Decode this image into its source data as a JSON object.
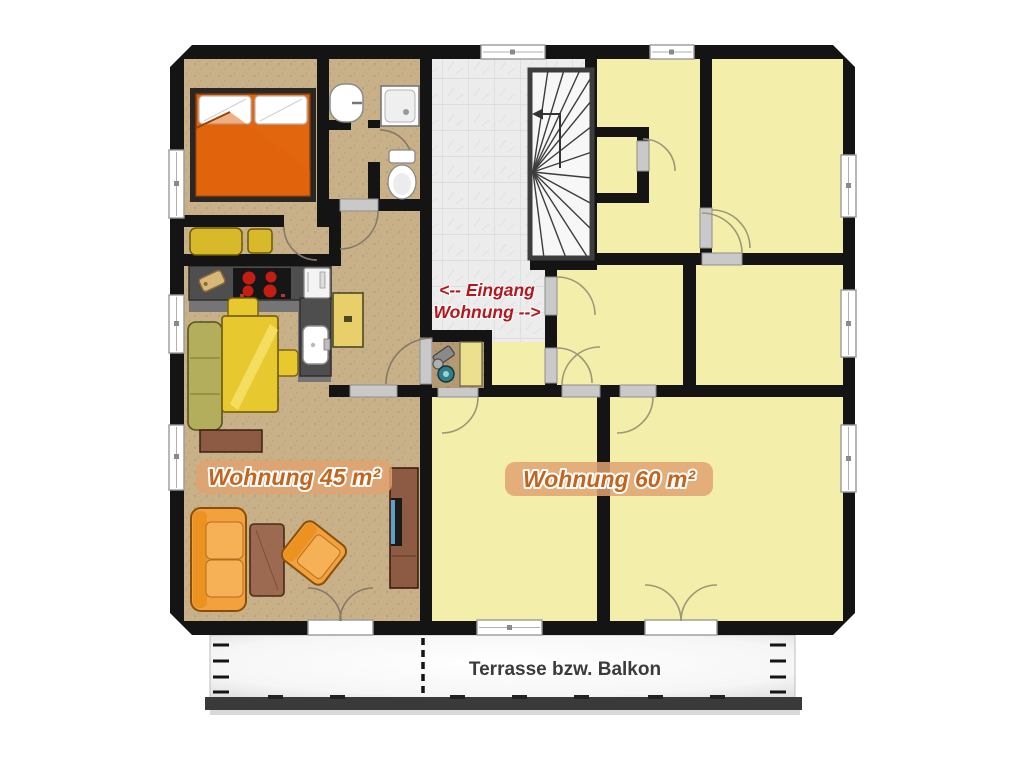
{
  "floor_plan": {
    "apartments": {
      "left": {
        "label": "Wohnung 45 m²"
      },
      "right": {
        "label": "Wohnung 60 m²"
      }
    },
    "entrance": {
      "line1": "<-- Eingang",
      "line2": "Wohnung -->"
    },
    "terrace": {
      "label": "Terrasse bzw. Balkon"
    }
  },
  "colors": {
    "wall": "#141414",
    "floor_apartment_45": "#c8b189",
    "floor_apartment_60": "#f4eeab",
    "floor_stairwell": "#ececec",
    "floor_kitchen": "#757575",
    "counter_gray": "#4e4e4e",
    "label_text": "#c4651f",
    "label_band": "#e0a271",
    "entrance_text": "#b2191f",
    "terrace_text": "#3b3b3b",
    "bed_blanket": "#e2660e",
    "sofa_orange": "#f2a13d",
    "table_yellow": "#e7c92f",
    "bench_olive": "#b3ae5c",
    "wood_brown": "#8d5b43",
    "stove_burner": "#c41e12",
    "tv_screen": "#5aa0c8"
  }
}
